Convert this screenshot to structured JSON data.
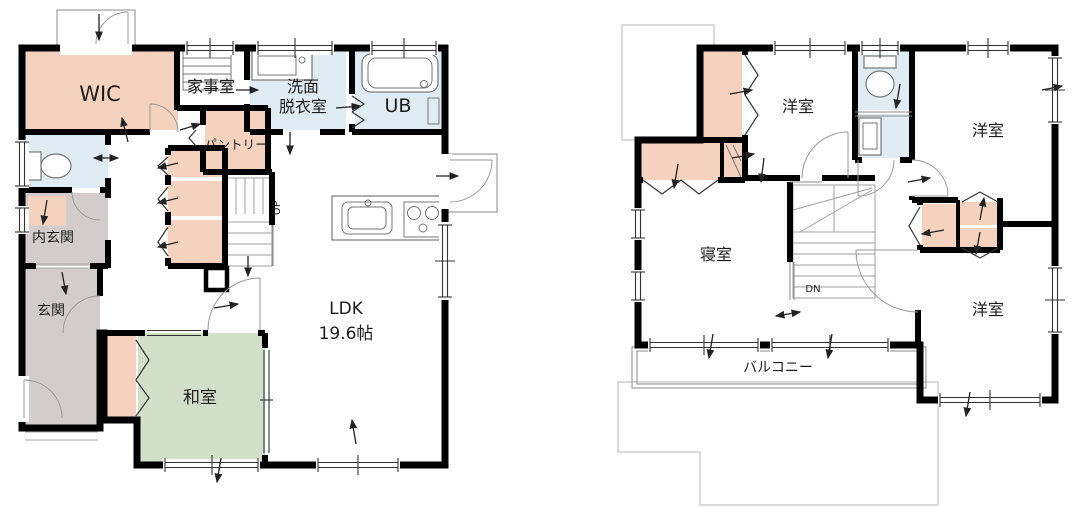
{
  "palette": {
    "wall": "#000000",
    "closet": "#f4d2bd",
    "wet": "#dfecf4",
    "tatami": "#d2e0c9",
    "entry": "#d2cccc",
    "porch": "#d2cccc",
    "paper": "#ffffff"
  },
  "floor1": {
    "rooms": {
      "wic": "WIC",
      "utility": "家事室",
      "washroom_line1": "洗面",
      "washroom_line2": "脱衣室",
      "bath": "UB",
      "pantry": "パントリー",
      "inner_entry": "内玄関",
      "entry": "玄関",
      "tatami": "和室",
      "ldk_line1": "LDK",
      "ldk_line2": "19.6帖",
      "stairs": "UP"
    }
  },
  "floor2": {
    "rooms": {
      "bedroom_top": "洋室",
      "bedroom_right": "洋室",
      "bedroom_bottom": "洋室",
      "master": "寝室",
      "stairs": "DN",
      "balcony": "バルコニー"
    }
  }
}
